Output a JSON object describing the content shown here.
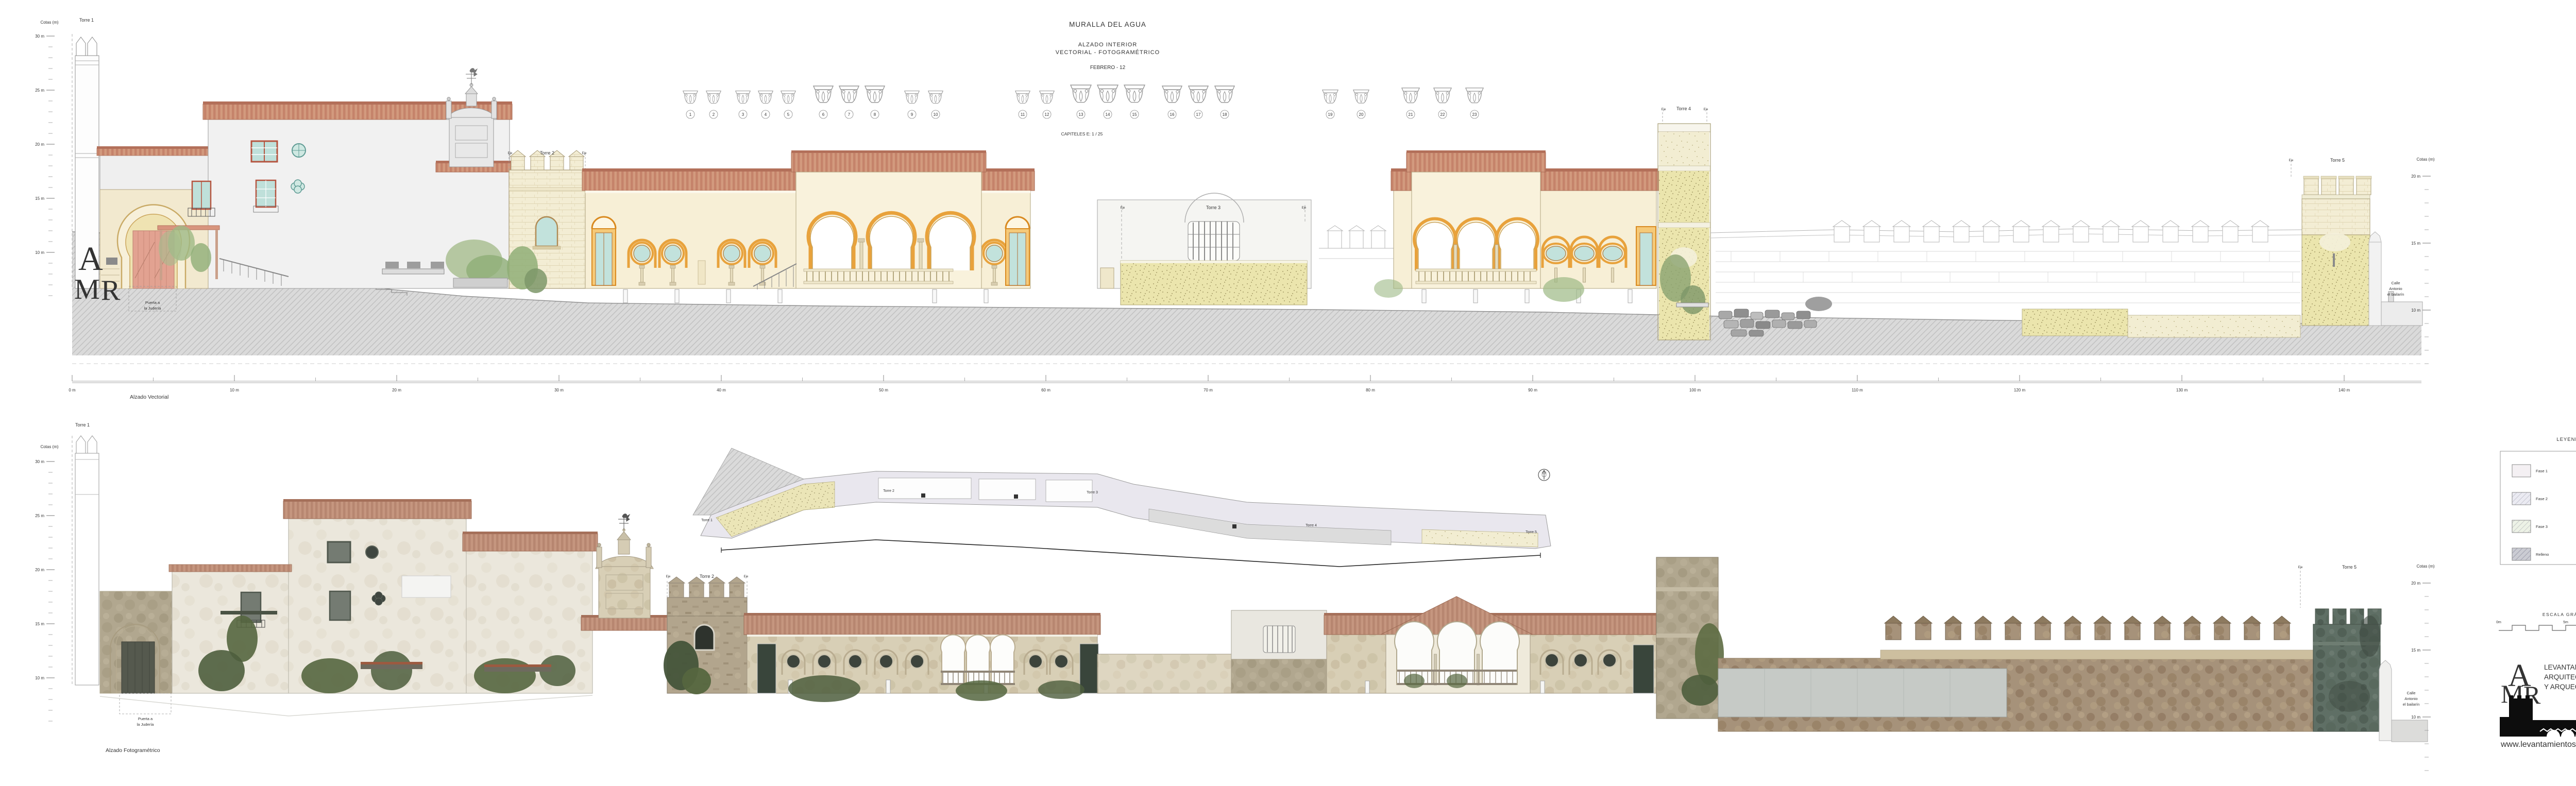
{
  "title_block": {
    "title": "MURALLA DEL AGUA",
    "subtitle_line1": "ALZADO  INTERIOR",
    "subtitle_line2": "VECTORIAL  -  FOTOGRAMÉTRICO",
    "date": "FEBRERO - 12"
  },
  "capitals": {
    "numbers": [
      1,
      2,
      3,
      4,
      5,
      6,
      7,
      8,
      9,
      10,
      11,
      12,
      13,
      14,
      15,
      16,
      17,
      18,
      19,
      20,
      21,
      22,
      23
    ],
    "scale_label": "CAPITELES    E: 1 / 25"
  },
  "drawings": {
    "vector_caption": "Alzado Vectorial",
    "photo_caption": "Alzado Fotogramétrico"
  },
  "towers": [
    "Torre 1",
    "Torre 2",
    "Torre 3",
    "Torre 4",
    "Torre 5"
  ],
  "axis_label": "Eje",
  "annotations": {
    "gate_line1": "Puerta a",
    "gate_line2": "la Judería",
    "street_line1": "Calle",
    "street_line2": "Antonio",
    "street_line3": "el bailarín"
  },
  "cotas": {
    "title": "Cotas (m)",
    "left_labels": [
      "30 m",
      "25 m",
      "20 m",
      "15 m",
      "10 m"
    ],
    "right_labels": [
      "20 m",
      "15 m",
      "10 m"
    ]
  },
  "ruler": {
    "labels": [
      "0 m",
      "10 m",
      "20 m",
      "30 m",
      "40 m",
      "50 m",
      "60 m",
      "70 m",
      "80 m",
      "90 m",
      "100 m",
      "110 m",
      "120 m",
      "130 m",
      "140 m"
    ]
  },
  "legend": {
    "title": "LEYENDA",
    "items": [
      {
        "label": "Fase 1",
        "color": "#f4f0f3",
        "pattern": "plain"
      },
      {
        "label": "Fase 2",
        "color": "#ebebf2",
        "pattern": "diag"
      },
      {
        "label": "Fase 3",
        "color": "#edf2e6",
        "pattern": "diag"
      },
      {
        "label": "Relleno",
        "color": "#cbccd3",
        "pattern": "hatch"
      },
      {
        "label": "Tapial restaurado",
        "color": "#f5f1da",
        "pattern": "dots"
      },
      {
        "label": "Tapial",
        "color": "#f1ecc4",
        "pattern": "dots"
      },
      {
        "label": "Enfoscado",
        "color": "#ece5bc",
        "pattern": "hlines"
      },
      {
        "label": "Sillares",
        "color": "#d9d9d9",
        "pattern": "stones"
      }
    ]
  },
  "scale_bar": {
    "title": "ESCALA  GRÁFICA",
    "labels": [
      "0m",
      "5m",
      "10m"
    ]
  },
  "logo": {
    "letter_a": "A",
    "letter_m": "M",
    "letter_r": "R",
    "line1": "LEVANTAMIENTOS",
    "line2": "ARQUITECTÓNICOS",
    "line3": "Y ARQUEOLÓGICOS",
    "website": "www.levantamientos.com"
  }
}
